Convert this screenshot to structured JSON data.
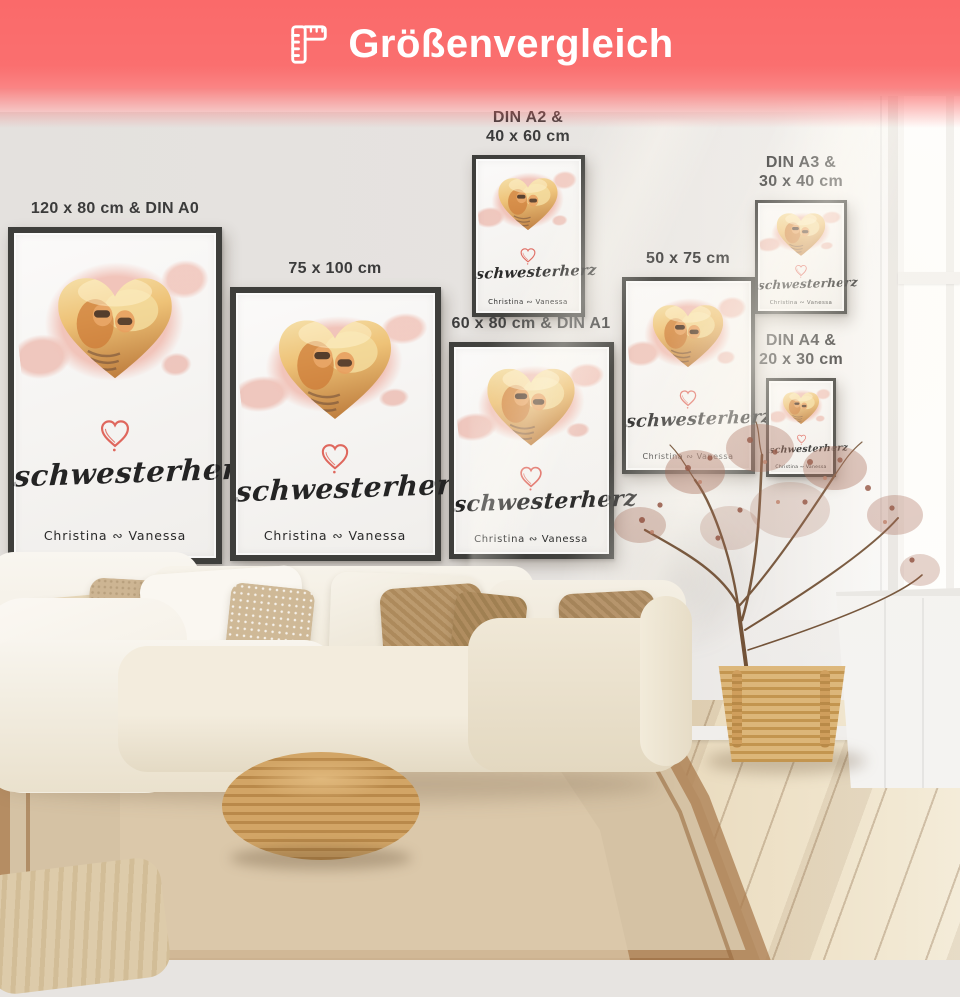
{
  "header": {
    "title": "Größenvergleich",
    "icon": "ruler-icon",
    "bg_color": "#fa6a6a",
    "text_color": "#ffffff"
  },
  "poster_artwork": {
    "title_script": "schwesterherz",
    "names": "Christina ∾ Vanessa",
    "accent_color": "#df675d",
    "watercolor_color": "#f2c6bc"
  },
  "posters": [
    {
      "id": "din-a0",
      "label_lines": [
        "120 x 80 cm & DIN A0"
      ]
    },
    {
      "id": "size-75x100",
      "label_lines": [
        "75 x 100 cm"
      ]
    },
    {
      "id": "din-a2",
      "label_lines": [
        "DIN A2 &",
        "40 x 60 cm"
      ]
    },
    {
      "id": "din-a1",
      "label_lines": [
        "60 x 80 cm & DIN A1"
      ]
    },
    {
      "id": "size-50x75",
      "label_lines": [
        "50 x 75 cm"
      ]
    },
    {
      "id": "din-a3",
      "label_lines": [
        "DIN A3 &",
        "30 x 40 cm"
      ]
    },
    {
      "id": "din-a4",
      "label_lines": [
        "DIN A4 &",
        "20 x 30 cm"
      ]
    }
  ]
}
